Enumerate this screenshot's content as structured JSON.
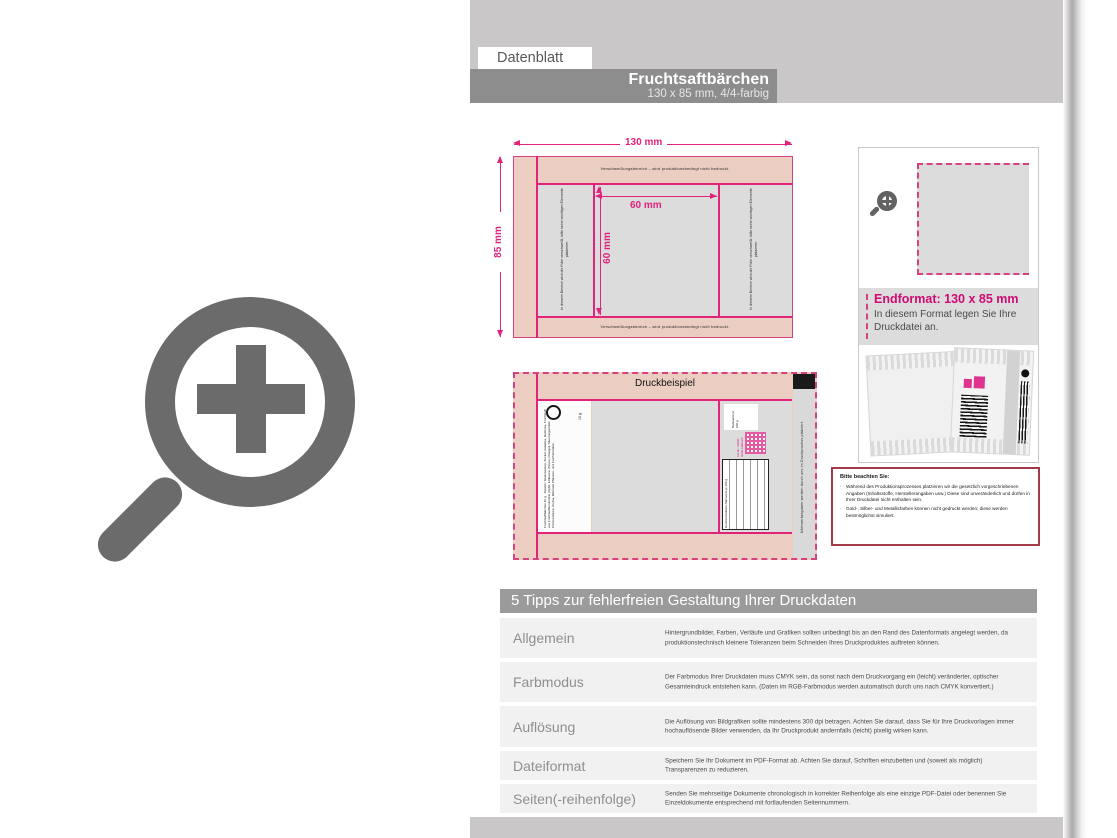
{
  "header": {
    "tab_label": "Datenblatt",
    "title": "Fruchtsaftbärchen",
    "subtitle": "130 x 85 mm, 4/4-farbig"
  },
  "diagram": {
    "width_label": "130 mm",
    "height_label": "85 mm",
    "inner_width_label": "60 mm",
    "inner_height_label": "60 mm",
    "seal_note_top": "Verschweißungsbereich – wird produktionsbedingt nicht bedruckt.",
    "seal_note_bottom": "Verschweißungsbereich – wird produktionsbedingt nicht bedruckt.",
    "side_note_left": "In diesem Bereich wird die Folie verschweißt, bitte keine wichtigen Elemente platzieren.",
    "side_note_right": "In diesem Bereich wird die Folie verschweißt, bitte keine wichtigen Elemente platzieren."
  },
  "druckbeispiel": {
    "label": "Druckbeispiel",
    "side_note": "Nährwertangaben werden durch uns im Druckprozess platziert.",
    "weight_note": "10 g",
    "legal_text": "Fruchtsaftbärchen 10 g · Zutaten: Glukosesirup, Zucker, Gelatine, Dextrose, Fruchtsaft aus Fruchtsaftkonzentrat (Apfel, Erdbeere, Zitrone, Orange), Säuerungsmittel: Citronensäure, Aroma, färbende Pflanzen- und Fruchtextrakte.",
    "nutrition_box_text": "Nährwerte je 100 g",
    "nutrition_table_header": "Durchschnittliche Nährwerte je 100 g",
    "lot_text": "Lot-Nr. / MHD: siehe Aufdruck"
  },
  "endformat": {
    "title": "Endformat: 130 x 85 mm",
    "line1": "In diesem Format legen Sie Ihre",
    "line2": "Druckdatei an."
  },
  "notice": {
    "title": "Bitte beachten Sie:",
    "bullet1": "Während des Produktionsprozesses platzieren wir die gesetzlich vorgeschriebenen Angaben (Inhaltsstoffe, Herstellerangaben usw.) Diese sind unveränderlich und dürfen in Ihrer Druckdatei nicht enthalten sein.",
    "bullet2": "Gold-, Silber- und Metallicfarben können nicht gedruckt werden; diese werden bestmöglichst simuliert."
  },
  "tips": {
    "header": "5 Tipps zur fehlerfreien Gestaltung Ihrer Druckdaten",
    "rows": [
      {
        "label": "Allgemein",
        "text": "Hintergrundbilder, Farben, Verläufe und Grafiken sollten unbedingt bis an den Rand des Datenformats angelegt werden, da produktionstechnisch kleinere Toleranzen beim Schneiden Ihres Druckproduktes auftreten können."
      },
      {
        "label": "Farbmodus",
        "text": "Der Farbmodus Ihrer Druckdaten muss CMYK sein, da sonst nach dem Druckvorgang ein (leicht) veränderter, optischer Gesamteindruck entstehen kann. (Daten im RGB-Farbmodus werden automatisch durch uns nach CMYK konvertiert.)"
      },
      {
        "label": "Auflösung",
        "text": "Die Auflösung von Bildgrafiken sollte mindestens 300 dpi betragen. Achten Sie darauf, dass Sie für Ihre Druckvorlagen immer hochauflösende Bilder verwenden, da Ihr Druckprodukt andernfalls (leicht) pixelig wirken kann."
      },
      {
        "label": "Dateiformat",
        "text": "Speichern Sie Ihr Dokument im PDF-Format ab. Achten Sie darauf, Schriften einzubetten und (soweit als möglich) Transparenzen zu reduzieren."
      },
      {
        "label": "Seiten(-reihenfolge)",
        "text": "Senden Sie mehrseitige Dokumente chronologisch in korrekter Reihenfolge als eine einzige PDF-Datei oder benennen Sie Einzeldokumente entsprechend mit fortlaufenden Seitennummern."
      }
    ]
  },
  "colors": {
    "dimension_magenta": "#e0247c",
    "dashed_magenta": "#d6417f",
    "endformat_magenta": "#cf0a72",
    "salmon_seal_area": "#eccdc1",
    "panel_gray": "#dcdcdc",
    "band_gray": "#c9c7c8",
    "title_bar_gray": "#8d8d8d",
    "table_header_gray": "#9b9b9b",
    "row_gray": "#f2f1f1",
    "notice_border": "#a43a4a",
    "icon_gray": "#6b6b6b"
  }
}
